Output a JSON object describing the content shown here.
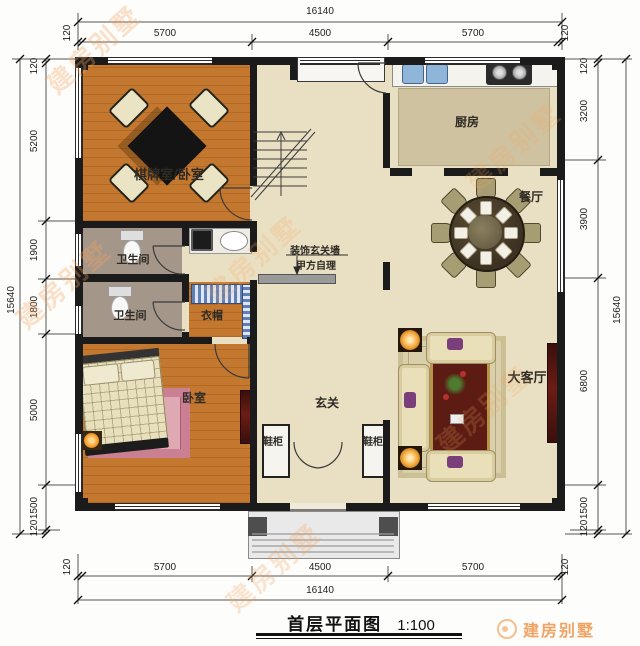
{
  "meta": {
    "title": "首层平面图",
    "scale": "1:100",
    "brand": "建房别墅",
    "watermark": "建房别墅"
  },
  "rooms": {
    "chess": "棋牌室/卧室",
    "kitchen": "厨房",
    "dining": "餐厅",
    "bath1": "卫生间",
    "bath2": "卫生间",
    "cloak": "衣帽",
    "bedroom": "卧室",
    "foyer": "玄关",
    "shoe_left": "鞋柜",
    "shoe_right": "鞋柜",
    "living": "大客厅"
  },
  "note": {
    "line1": "装饰玄关墙",
    "line2": "甲方自理"
  },
  "dims": {
    "top": {
      "total": "16140",
      "e1": "120",
      "s1": "5700",
      "s2": "4500",
      "s3": "5700",
      "e2": "120"
    },
    "bottom": {
      "total": "16140",
      "e1": "120",
      "s1": "5700",
      "s2": "4500",
      "s3": "5700",
      "e2": "120"
    },
    "left": {
      "total": "15640",
      "e1": "120",
      "s1": "5200",
      "s2": "1900",
      "s3": "1800",
      "s4": "5000",
      "s5": "1500",
      "e2": "120"
    },
    "right": {
      "total": "15640",
      "e1": "120",
      "s1": "3200",
      "s2": "3900",
      "s3": "6800",
      "s4": "1500",
      "e2": "120"
    }
  },
  "colors": {
    "wall": "#1b1b1b",
    "wood_floor": "#c4782f",
    "beige_floor": "#e9e0c3",
    "bath_floor": "#a5968a",
    "brand_orange": "#ee8c3c",
    "rug_red": "#5c1c14",
    "rug_pink": "#cb7f92",
    "wardrobe_blue": "#5d7fb5"
  }
}
